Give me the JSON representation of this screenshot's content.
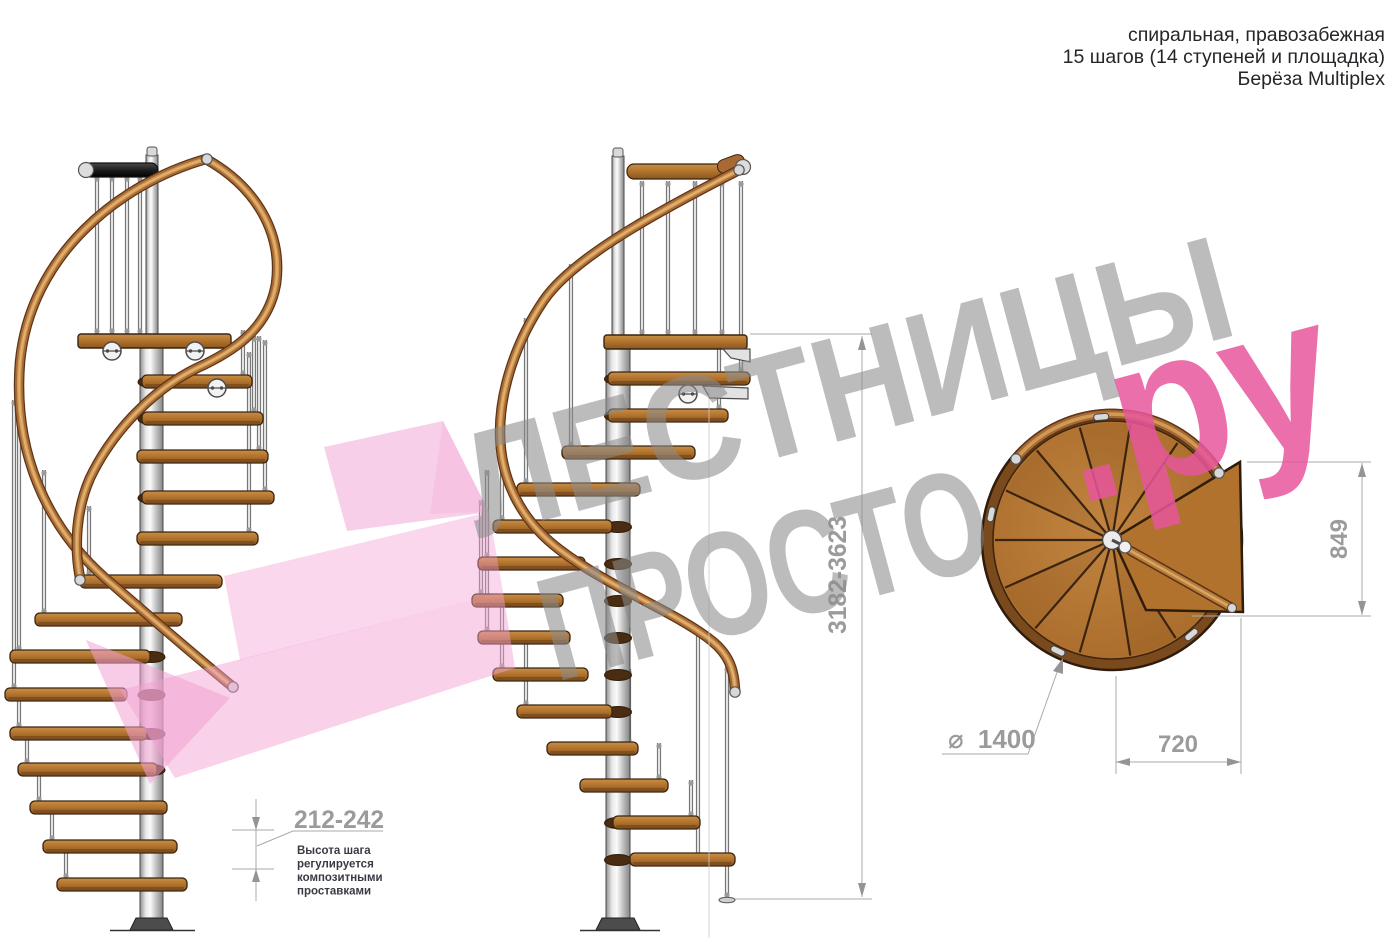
{
  "header": {
    "line1": "спиральная, правозабежная",
    "line2": "15 шагов (14 ступеней и площадка)",
    "line3": "Берёза Multiplex"
  },
  "watermark": {
    "word1": "ЛЕСТНИЦЫ",
    "word2": "ПРОСТО",
    "word3": ".ру"
  },
  "dimensions": {
    "total_height": "3182-3623",
    "step_height": "212-242",
    "step_note": [
      "Высота шага",
      "регулируется",
      "композитными",
      "проставками"
    ],
    "platform_depth": "849",
    "platform_width": "720",
    "diameter_symbol": "⌀",
    "diameter": "1400"
  },
  "colors": {
    "wood": "#b0722c",
    "wood_dark": "#3a2410",
    "rail_outline": "#5d3415",
    "rail_wood": "#a86a35",
    "rail_light": "#cf9a55",
    "metal_light": "#ececec",
    "metal_mid": "#9a9a9a",
    "dim_gray": "#9b9b9b",
    "dim_line": "#a9a9a9",
    "note_text": "#3a3a44",
    "header_text": "#26262a",
    "watermark_gray": "#8c8c8c",
    "watermark_pink": "#e8569c",
    "arrow_pink": "#f2a0d2"
  }
}
